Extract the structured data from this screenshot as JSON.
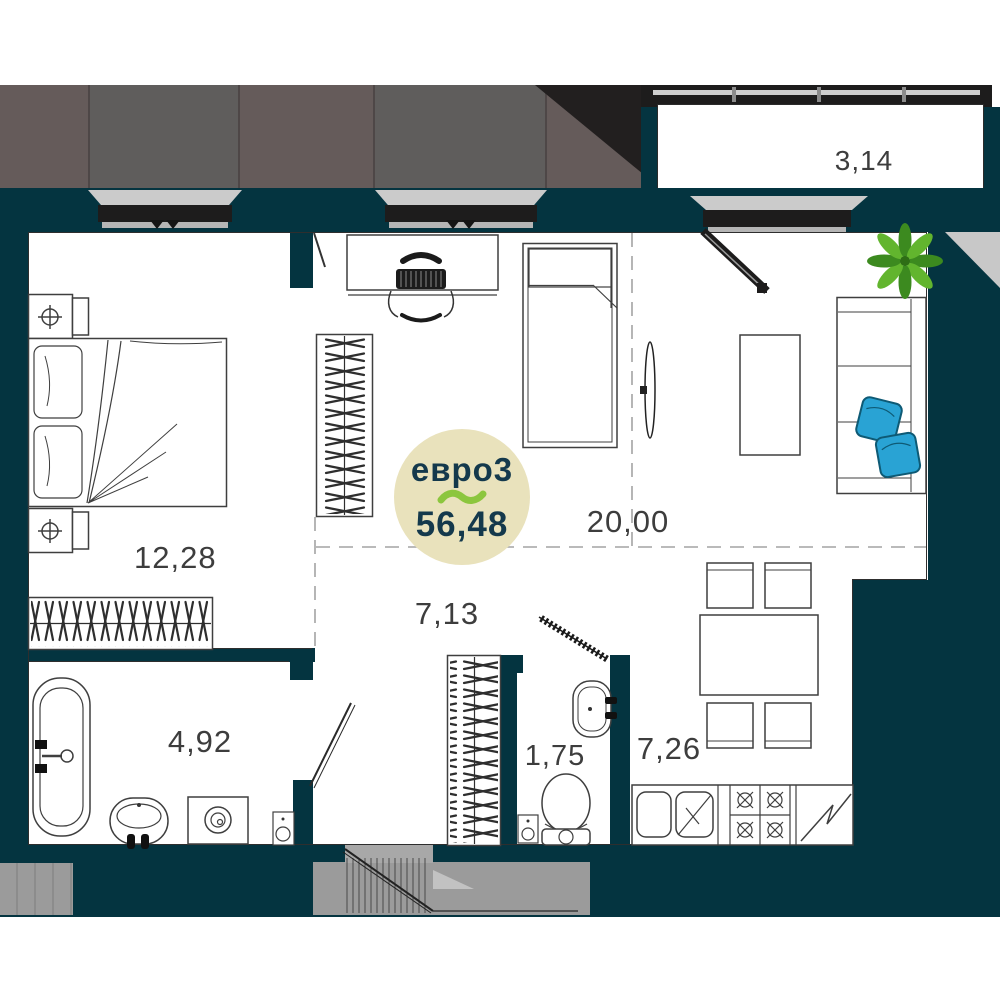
{
  "badge": {
    "plan_type": "евро3",
    "separator": "~",
    "total_area": "56,48"
  },
  "rooms": {
    "balcony": {
      "area": "3,14"
    },
    "bedroom": {
      "area": "12,28"
    },
    "living_room": {
      "area": "20,00"
    },
    "hallway": {
      "area": "7,13"
    },
    "bathroom": {
      "area": "4,92"
    },
    "wc": {
      "area": "1,75"
    },
    "kitchen": {
      "area": "7,26"
    }
  },
  "colors": {
    "wall_teal": "#043440",
    "facade_dark": "#655b5a",
    "facade_light": "#5f5d5c",
    "frame_black": "#1d1c1c",
    "sill_gray": "#cbcbcb",
    "corridor_gray": "#9b9b9b",
    "badge_bg": "#e9e2bc",
    "badge_text": "#14394c",
    "accent_green": "#8cc63e",
    "pillow_blue": "#29a3d4",
    "plant_green": "#5aab2d"
  }
}
